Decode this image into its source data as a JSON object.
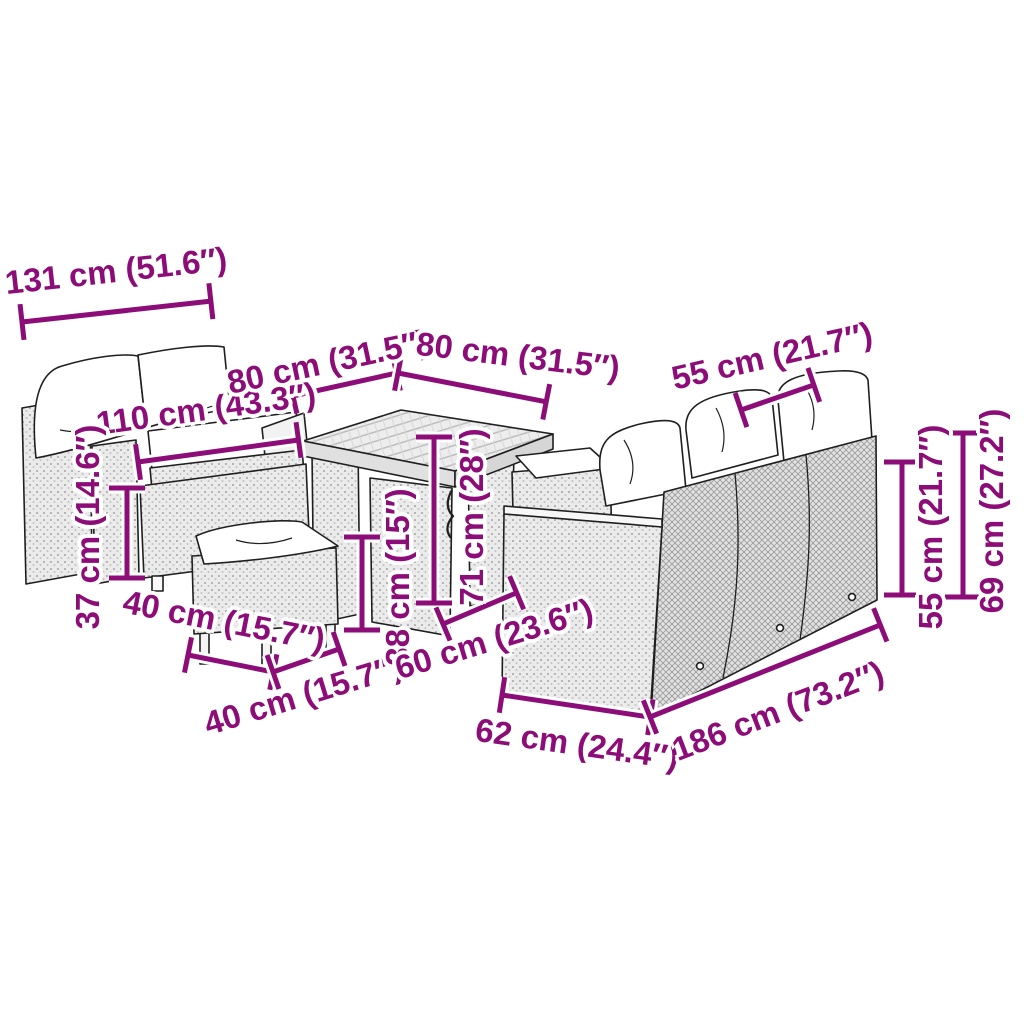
{
  "diagram": {
    "type": "product-dimension-diagram",
    "subject": "poly-rattan-garden-furniture-set",
    "style": {
      "accent_color": "#8c0c78",
      "outline_color": "#1f1f1f",
      "background_color": "#ffffff",
      "wicker_fill": "#ebebeb",
      "cushion_fill": "#ffffff"
    },
    "labels": {
      "bench_width": "131 cm (51.6″)",
      "bench_seat_width": "110 cm (43.3″)",
      "table_width_left": "80 cm (31.5″)",
      "table_width_right": "80 cm (31.5″)",
      "sofa_cushion_width": "55 cm (21.7″)",
      "bench_seat_height": "37 cm (14.6″)",
      "stool_width": "40 cm (15.7″)",
      "stool_depth": "40 cm (15.7″)",
      "stool_height": "38 cm (15″)",
      "table_height": "71 cm (28″)",
      "sofa_arm_width": "60 cm (23.6″)",
      "sofa_depth": "62 cm (24.4″)",
      "sofa_width": "186 cm (73.2″)",
      "sofa_back_height": "55 cm (21.7″)",
      "sofa_total_height": "69 cm (27.2″)"
    }
  }
}
